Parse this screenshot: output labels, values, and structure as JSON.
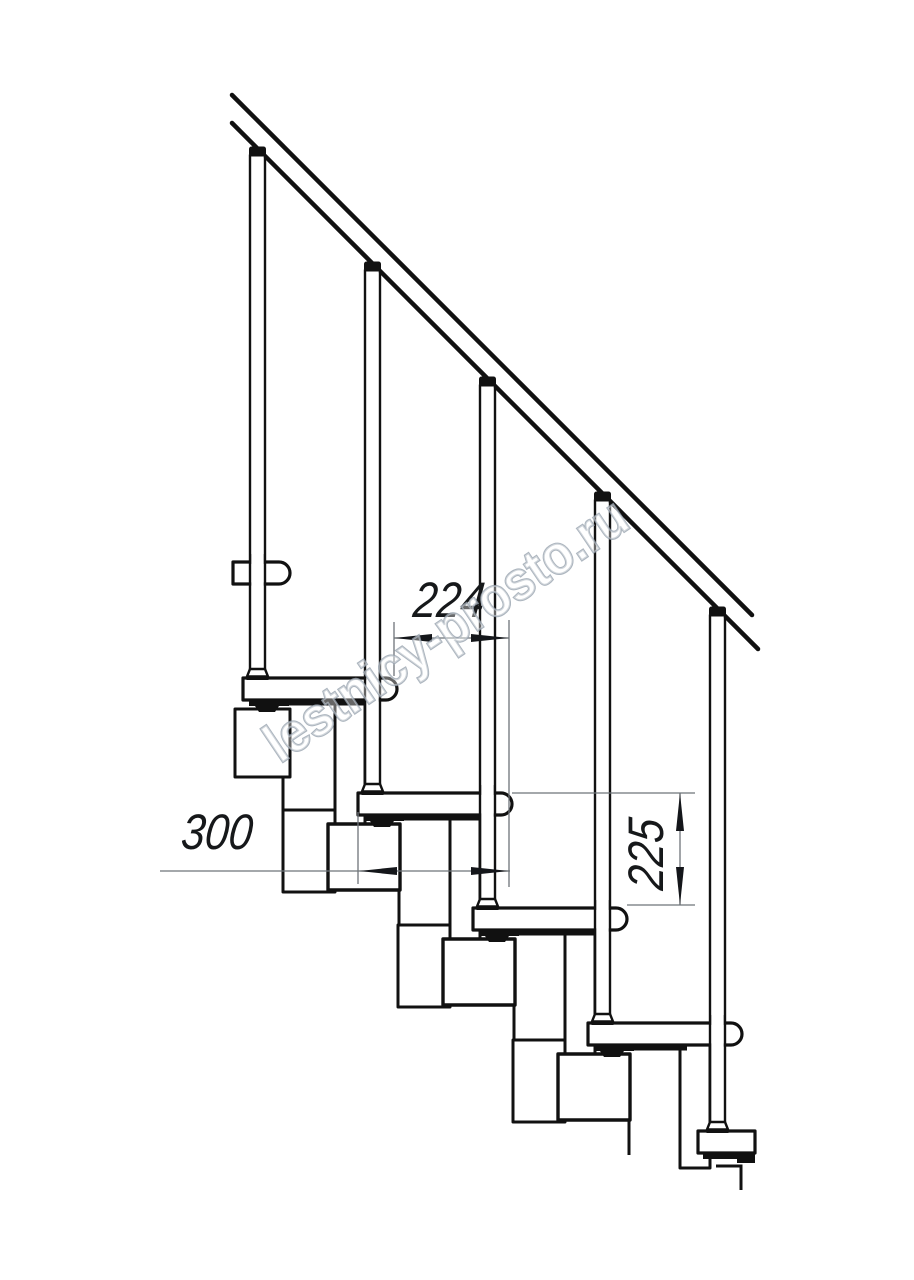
{
  "drawing": {
    "title": "Modular staircase side-view technical drawing",
    "dimensions": {
      "step_going": "224",
      "tread_depth": "300",
      "step_rise": "225"
    },
    "watermark": "lestnicy-prosto.ru",
    "colors": {
      "line": "#111111",
      "dim_line": "#6e7479",
      "arrow": "#14161a",
      "watermark_stroke": "#98a3af",
      "background": "#ffffff"
    }
  }
}
